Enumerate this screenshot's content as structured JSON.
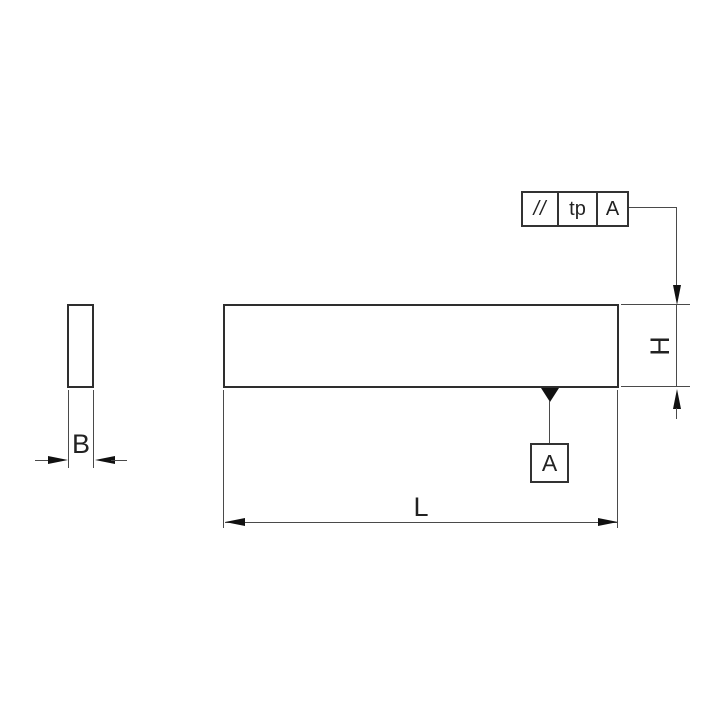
{
  "drawing": {
    "type": "technical-dimension-drawing",
    "views": {
      "side_view": "small vertical rectangle (thickness view)",
      "front_view": "long horizontal rectangle (length view)"
    },
    "dimensions": {
      "width_label": "B",
      "height_label": "H",
      "length_label": "L"
    },
    "feature_control_frame": {
      "geometric_symbol": "//",
      "geometric_symbol_meaning": "parallelism-icon",
      "tolerance_value": "tp",
      "datum_reference": "A"
    },
    "datum": {
      "label": "A"
    },
    "colors": {
      "background": "#ffffff",
      "object_line": "#2e2e2e",
      "dimension_line": "#4a4a4a",
      "arrow_fill": "#111111",
      "text": "#222222"
    }
  }
}
